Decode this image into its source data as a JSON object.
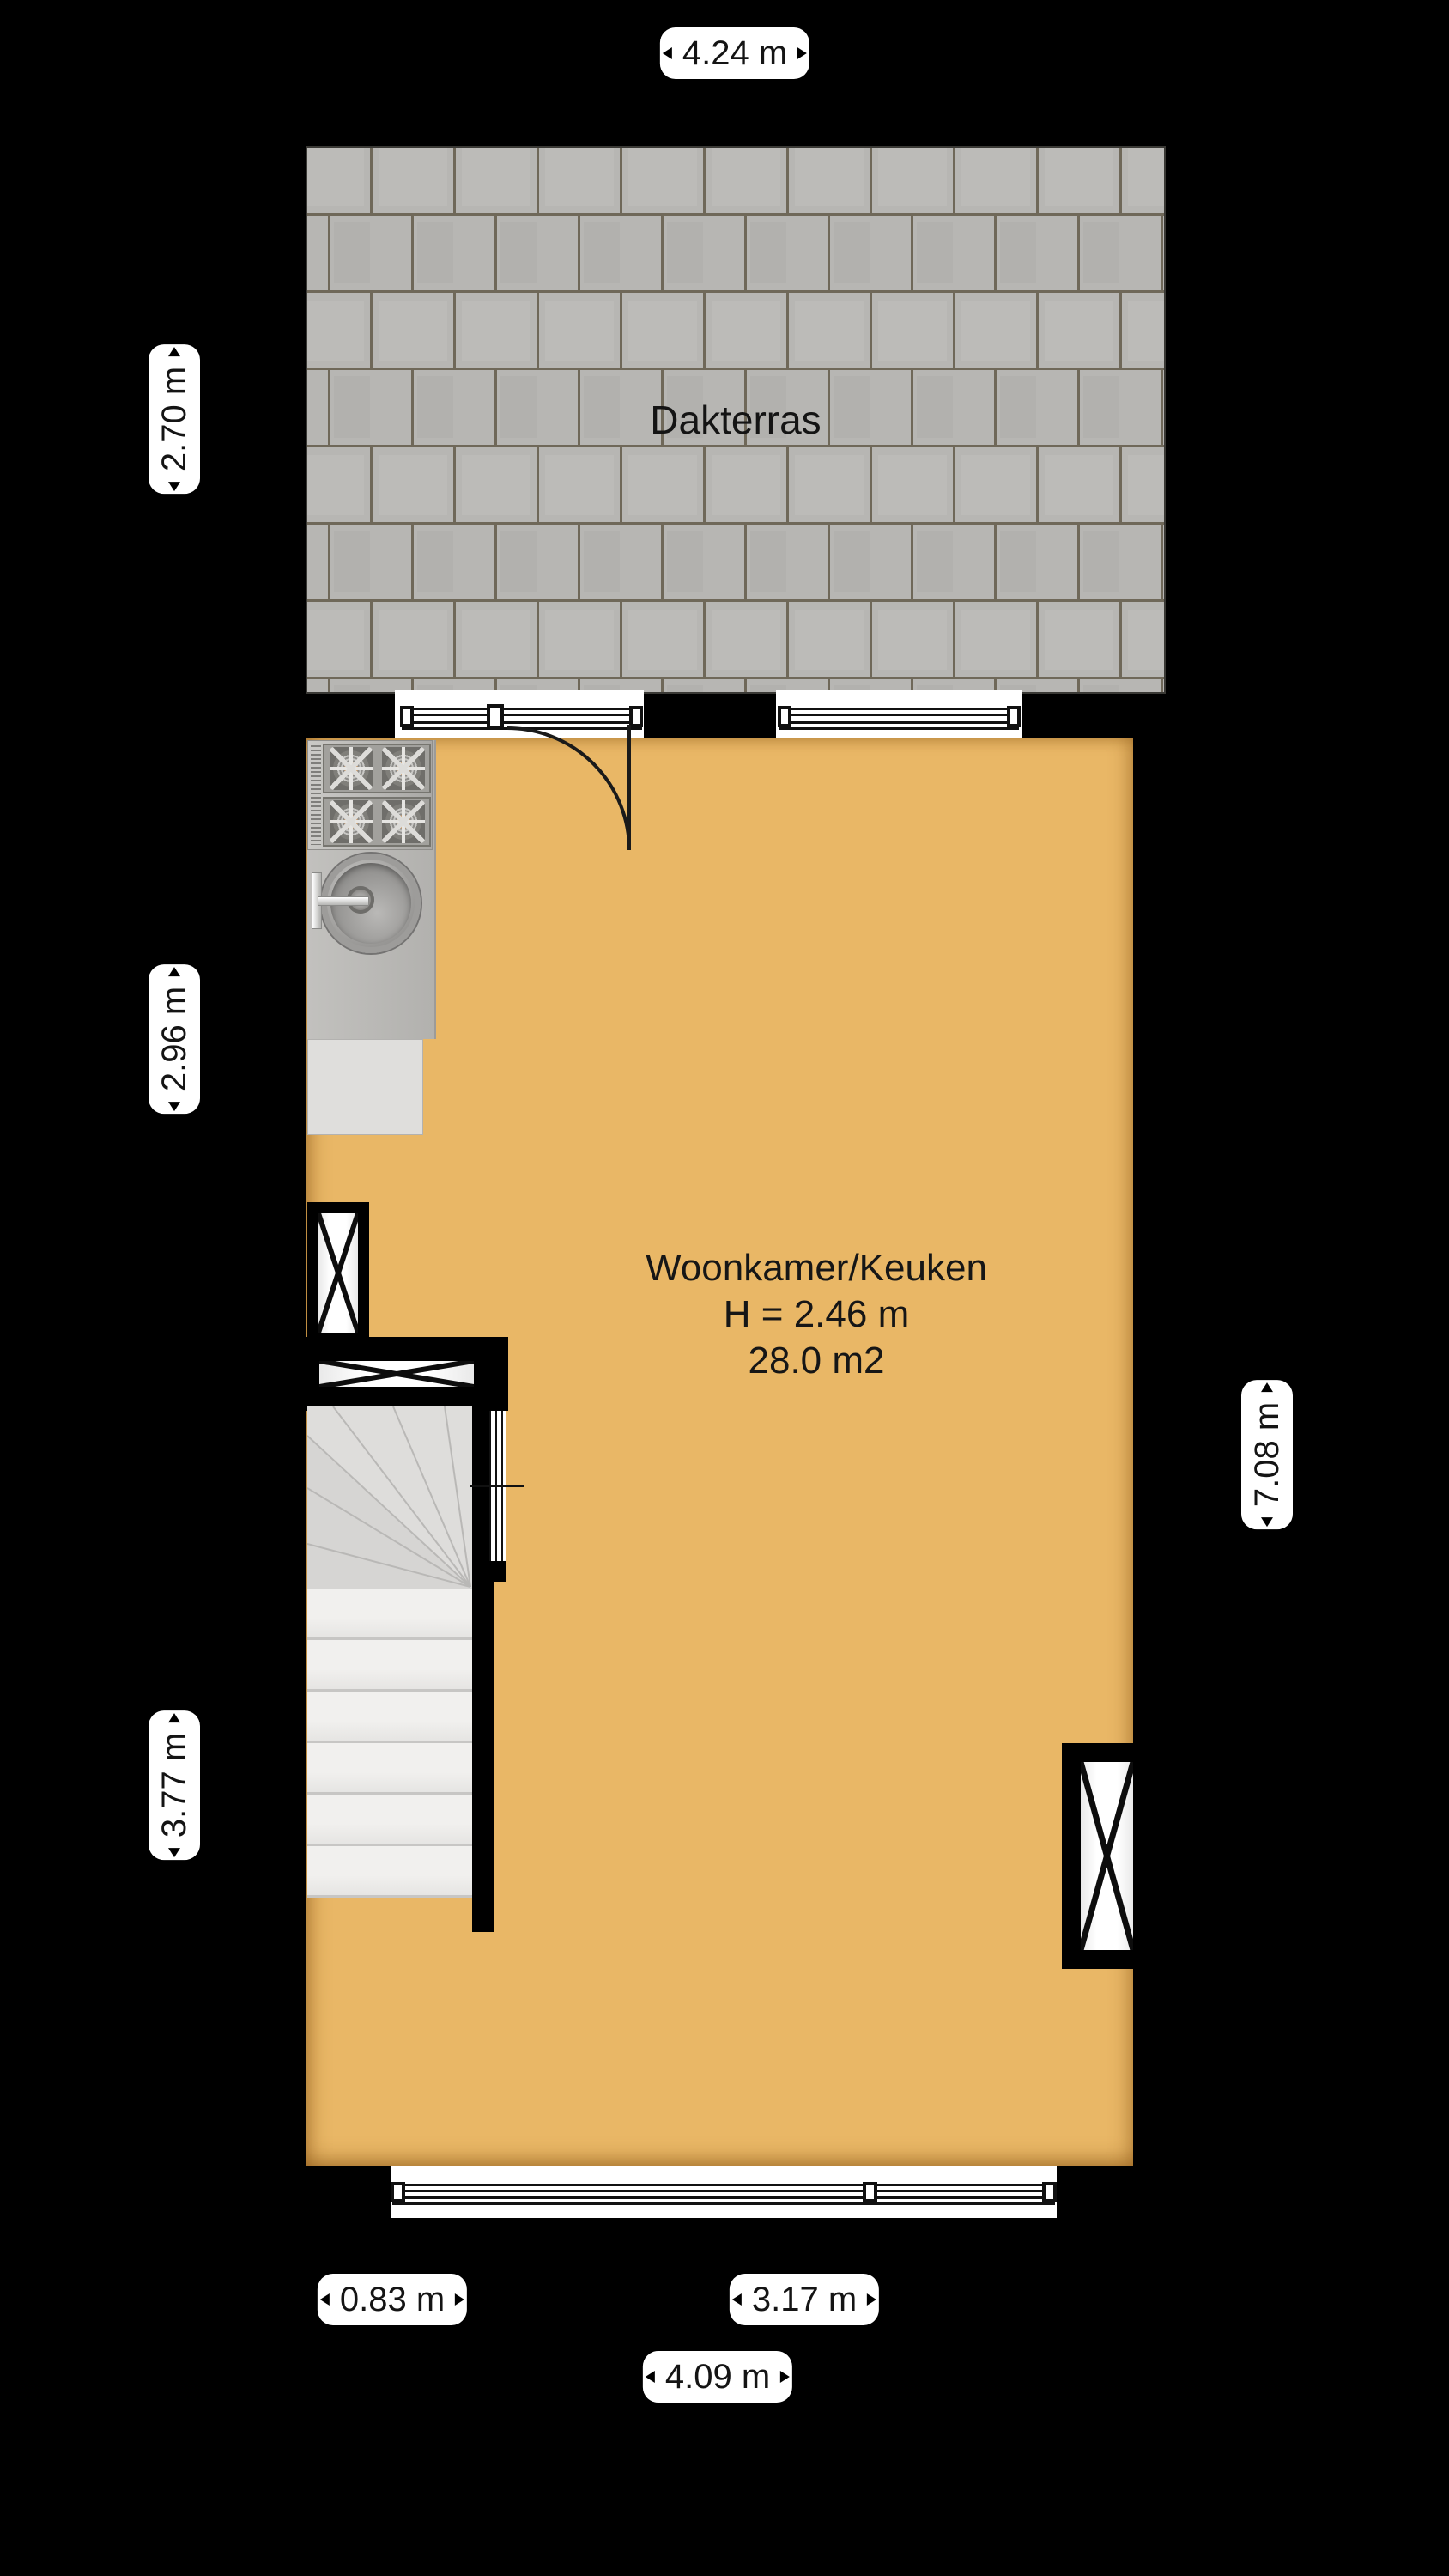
{
  "terrace": {
    "label": "Dakterras"
  },
  "room": {
    "name": "Woonkamer/Keuken",
    "height": "H = 2.46 m",
    "area": "28.0 m2"
  },
  "dims": {
    "top": "4.24 m",
    "left_terrace": "2.70 m",
    "left_kitchen": "2.96 m",
    "left_stairs": "3.77 m",
    "right_room": "7.08 m",
    "bottom_left": "0.83 m",
    "bottom_right": "3.17 m",
    "bottom_total": "4.09 m"
  },
  "colors": {
    "background": "#000000",
    "floor": "#e9b766",
    "paver": "#b7b6b3",
    "paver_joint": "#6f6859",
    "label_bg": "#ffffff",
    "label_text": "#141414"
  }
}
